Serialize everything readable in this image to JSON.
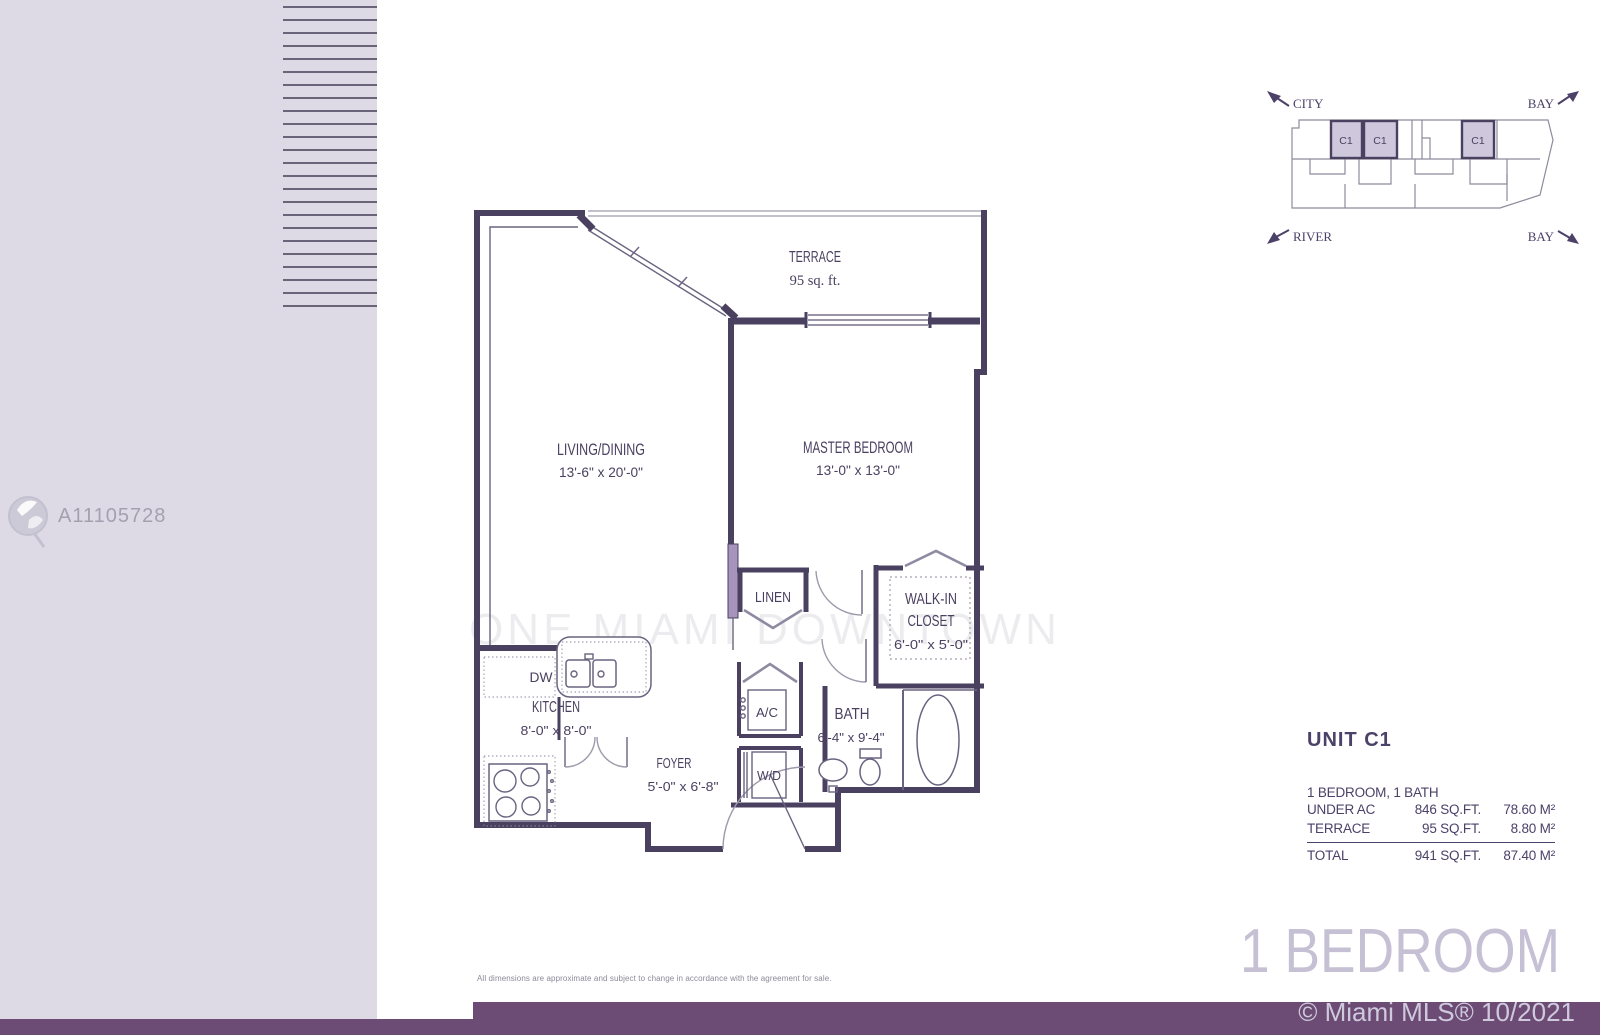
{
  "listing_watermark": {
    "id": "A11105728"
  },
  "plan_watermark": "ONE MIAMI DOWNTOWN",
  "key_plan": {
    "city": "CITY",
    "bay_top": "BAY",
    "river": "RIVER",
    "bay_bottom": "BAY",
    "units": [
      "C1",
      "C1",
      "C1"
    ]
  },
  "floor_plan": {
    "terrace": {
      "name": "TERRACE",
      "area": "95 sq. ft."
    },
    "living": {
      "name": "LIVING/DINING",
      "dims": "13'-6\" x 20'-0\""
    },
    "master": {
      "name": "MASTER BEDROOM",
      "dims": "13'-0\" x 13'-0\""
    },
    "linen": {
      "name": "LINEN"
    },
    "walkin": {
      "name1": "WALK-IN",
      "name2": "CLOSET",
      "dims": "6'-0\" x 5'-0\""
    },
    "kitchen": {
      "name": "KITCHEN",
      "dims": "8'-0\" x 8'-0\""
    },
    "dw": {
      "name": "DW"
    },
    "ac": {
      "name": "A/C"
    },
    "wd": {
      "name": "W/D"
    },
    "bath": {
      "name": "BATH",
      "dims": "6'-4\" x 9'-4\""
    },
    "foyer": {
      "name": "FOYER",
      "dims": "5'-0\" x 6'-8\""
    }
  },
  "unit_info": {
    "title": "UNIT C1",
    "subtitle": "1 BEDROOM, 1 BATH",
    "rows": [
      {
        "label": "UNDER AC",
        "sqft": "846 SQ.FT.",
        "m2": "78.60 M²"
      },
      {
        "label": "TERRACE",
        "sqft": "95 SQ.FT.",
        "m2": "8.80 M²"
      },
      {
        "label": "TOTAL",
        "sqft": "941 SQ.FT.",
        "m2": "87.40 M²"
      }
    ]
  },
  "footer": {
    "disclaimer": "All dimensions are approximate and subject to change in accordance with the agreement for sale.",
    "plan_type": "1 BEDROOM",
    "copyright": "© Miami MLS® 10/2021"
  },
  "colors": {
    "panel": "#dedae5",
    "bar": "#6c4c74",
    "wall": "#4a4060",
    "highlight": "#cfc8dd",
    "light_text": "#c6c0d5"
  }
}
